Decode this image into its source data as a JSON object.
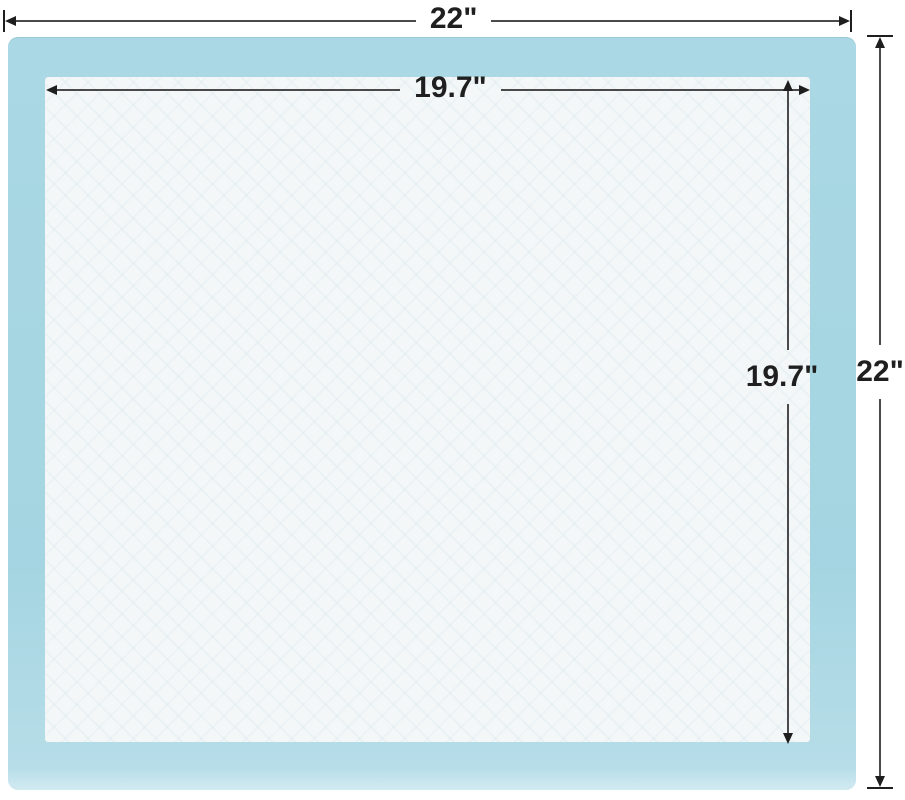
{
  "page": {
    "background_color": "#ffffff",
    "description": "Dimension diagram of a square pad with blue border and white absorbent core"
  },
  "pad": {
    "outer_color": "#a8d7e3",
    "inner_color": "#f3f7f8",
    "line_color": "#4a4a4a",
    "marker_color": "#1e1e1e",
    "text_color": "#1f1f1f"
  },
  "dimensions": {
    "outer_width": {
      "label": "22\""
    },
    "outer_height": {
      "label": "22\""
    },
    "inner_width": {
      "label": "19.7\""
    },
    "inner_height": {
      "label": "19.7\""
    }
  }
}
